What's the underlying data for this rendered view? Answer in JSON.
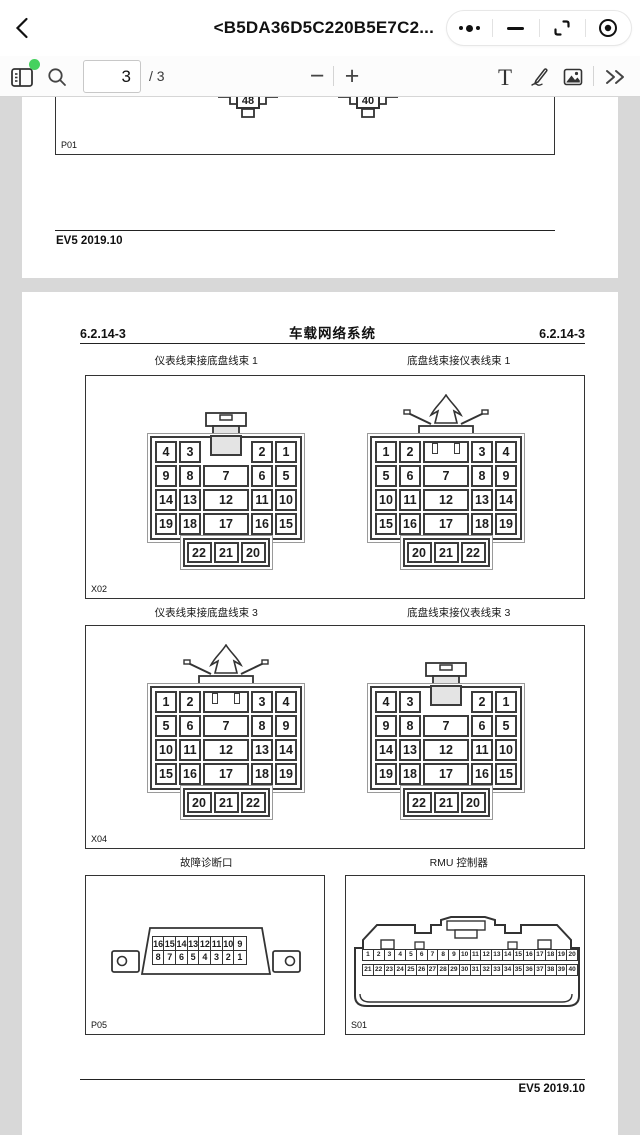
{
  "nav": {
    "back_icon": "chevron-left",
    "title": "<B5DA36D5C220B5E7C2...",
    "capsule": {
      "more_icon": "three-dots",
      "minimize_icon": "minus-bar",
      "float_window_icon": "corner-brackets",
      "close_icon": "circle-dot"
    }
  },
  "toolbar": {
    "sidebar_icon": "thumbnails-panel",
    "badge_color": "#45d15e",
    "search_icon": "magnifier",
    "page_current": "3",
    "page_total_label": "/ 3",
    "zoom_out_label": "−",
    "zoom_in_label": "+",
    "text_tool_label": "T",
    "pen_icon": "pencil",
    "image_icon": "picture",
    "more_tools_icon": "double-chevron-right"
  },
  "doc": {
    "line_color": "#333333",
    "page1": {
      "figure_label": "P01",
      "tab_left": "48",
      "tab_right": "40",
      "footer": "EV5 2019.10"
    },
    "page2": {
      "header_left": "6.2.14-3",
      "header_center": "车载网络系统",
      "header_right": "6.2.14-3",
      "fig1_caption_left": "仪表线束接底盘线束 1",
      "fig1_caption_right": "底盘线束接仪表线束 1",
      "fig1_label": "X02",
      "fig2_caption_left": "仪表线束接底盘线束 3",
      "fig2_caption_right": "底盘线束接仪表线束 3",
      "fig2_label": "X04",
      "fig3_caption_left": "故障诊断口",
      "fig3_caption_right": "RMU 控制器",
      "fig3_label_left": "P05",
      "fig3_label_right": "S01",
      "footer": "EV5 2019.10"
    }
  },
  "connectors": {
    "latch22": {
      "rows": [
        [
          "4",
          "3",
          "",
          "2",
          "1"
        ],
        [
          "9",
          "8",
          "7",
          "6",
          "5"
        ],
        [
          "14",
          "13",
          "12",
          "11",
          "10"
        ],
        [
          "19",
          "18",
          "17",
          "16",
          "15"
        ]
      ],
      "bottom": [
        "22",
        "21",
        "20"
      ]
    },
    "clip22": {
      "rows": [
        [
          "1",
          "2",
          "",
          "3",
          "4"
        ],
        [
          "5",
          "6",
          "7",
          "8",
          "9"
        ],
        [
          "10",
          "11",
          "12",
          "13",
          "14"
        ],
        [
          "15",
          "16",
          "17",
          "18",
          "19"
        ]
      ],
      "bottom": [
        "20",
        "21",
        "22"
      ]
    },
    "obd": {
      "row_top": [
        "16",
        "15",
        "14",
        "13",
        "12",
        "11",
        "10",
        "9"
      ],
      "row_bottom": [
        "8",
        "7",
        "6",
        "5",
        "4",
        "3",
        "2",
        "1"
      ]
    },
    "rmu": {
      "row_top": [
        "1",
        "2",
        "3",
        "4",
        "5",
        "6",
        "7",
        "8",
        "9",
        "10",
        "11",
        "12",
        "13",
        "14",
        "15",
        "16",
        "17",
        "18",
        "19",
        "20"
      ],
      "row_bottom": [
        "21",
        "22",
        "23",
        "24",
        "25",
        "26",
        "27",
        "28",
        "29",
        "30",
        "31",
        "32",
        "33",
        "34",
        "35",
        "36",
        "37",
        "38",
        "39",
        "40"
      ]
    }
  }
}
